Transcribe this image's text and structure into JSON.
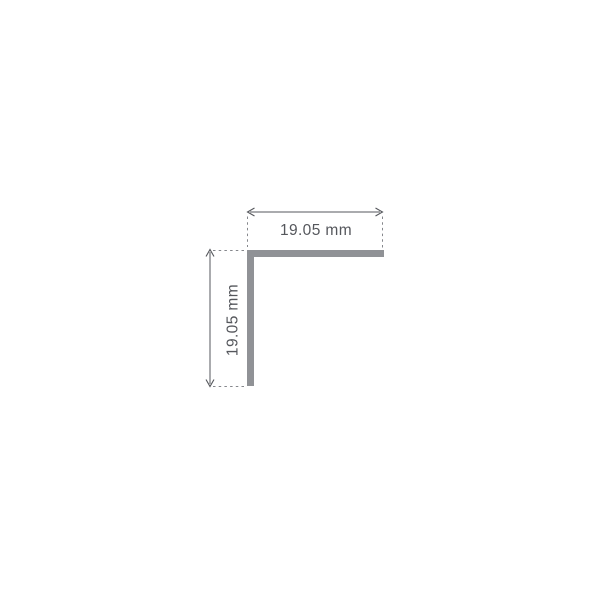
{
  "drawing": {
    "horizontal_dimension_label": "19.05 mm",
    "vertical_dimension_label": "19.05 mm",
    "colors": {
      "background": "#ffffff",
      "profile_fill": "#909296",
      "dimension_line": "#55575c",
      "extension_line": "#85878c",
      "label_text": "#55575c"
    }
  }
}
